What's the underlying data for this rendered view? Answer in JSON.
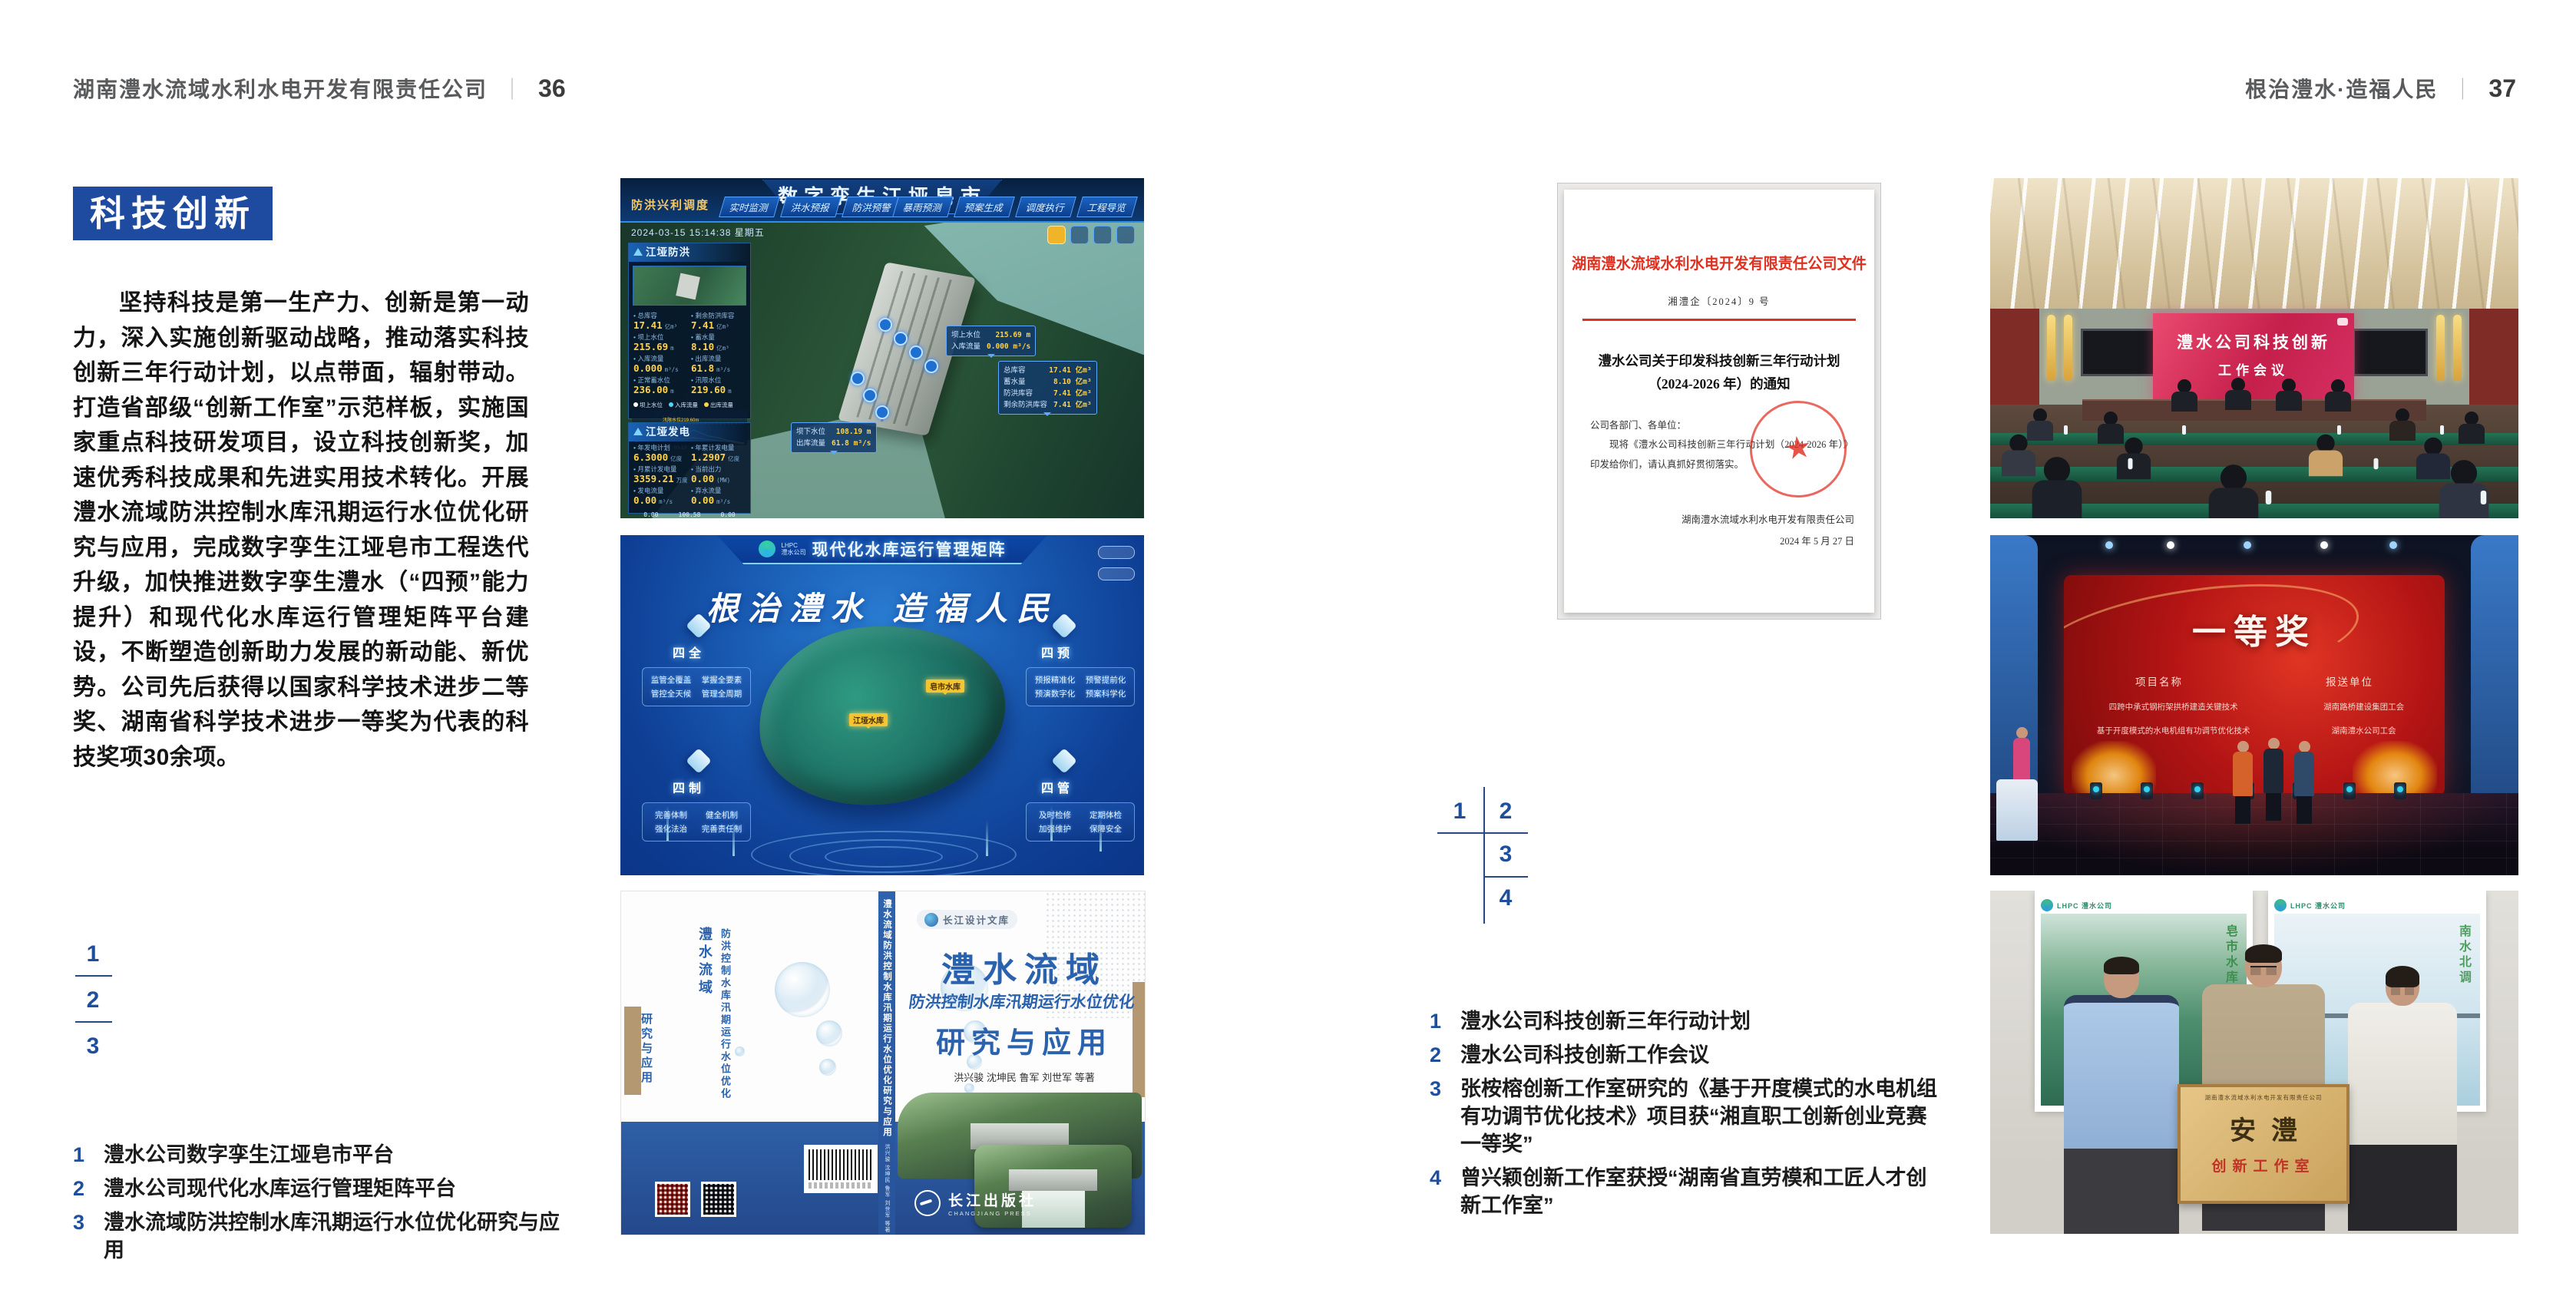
{
  "colors": {
    "accent_blue": "#1e4b9f",
    "caption_blue": "#1f4e9c",
    "doc_red": "#e03020",
    "band_blue": "#2e5fa6"
  },
  "page_left": {
    "header": {
      "company": "湖南澧水流域水利水电开发有限责任公司",
      "page_no": "36"
    },
    "section_badge": "科技创新",
    "body_text": "坚持科技是第一生产力、创新是第一动力，深入实施创新驱动战略，推动落实科技创新三年行动计划，以点带面，辐射带动。打造省部级“创新工作室”示范样板，实施国家重点科技研发项目，设立科技创新奖，加速优秀科技成果和先进实用技术转化。开展澧水流域防洪控制水库汛期运行水位优化研究与应用，完成数字孪生江垭皂市工程迭代升级，加快推进数字孪生澧水（“四预”能力提升）和现代化水库运行管理矩阵平台建设，不断塑造创新助力发展的新动能、新优势。公司先后获得以国家科学技术进步二等奖、湖南省科学技术进步一等奖为代表的科技奖项30余项。",
    "figure_nums": [
      "1",
      "2",
      "3"
    ],
    "captions": [
      {
        "num": "1",
        "text": "澧水公司数字孪生江垭皂市平台"
      },
      {
        "num": "2",
        "text": "澧水公司现代化水库运行管理矩阵平台"
      },
      {
        "num": "3",
        "text": "澧水流域防洪控制水库汛期运行水位优化研究与应用"
      }
    ]
  },
  "page_right": {
    "header": {
      "slogan": "根治澧水·造福人民",
      "page_no": "37"
    },
    "figure_nums": [
      "1",
      "2",
      "3",
      "4"
    ],
    "captions": [
      {
        "num": "1",
        "text": "澧水公司科技创新三年行动计划"
      },
      {
        "num": "2",
        "text": "澧水公司科技创新工作会议"
      },
      {
        "num": "3",
        "text": "张桉榕创新工作室研究的《基于开度模式的水电机组有功调节优化技术》项目获“湘直职工创新创业竞赛一等奖”"
      },
      {
        "num": "4",
        "text": "曾兴颖创新工作室获授“湖南省直劳模和工匠人才创新工作室”"
      }
    ]
  },
  "fig_dashboard": {
    "title": "数字孪生江垭皂市",
    "mode_label": "防洪兴利调度",
    "tabs_left": [
      "实时监测",
      "洪水预报",
      "防洪预警"
    ],
    "tabs_right": [
      "暴雨预测",
      "预案生成",
      "调度执行",
      "工程导览"
    ],
    "datetime": "2024-03-15 15:14:38 星期五",
    "panel_flood": {
      "title": "江垭防洪",
      "stats": [
        {
          "label": "总库容",
          "value": "17.41",
          "unit": "亿m³"
        },
        {
          "label": "剩余防洪库容",
          "value": "7.41",
          "unit": "亿m³"
        },
        {
          "label": "坝上水位",
          "value": "215.69",
          "unit": "m"
        },
        {
          "label": "蓄水量",
          "value": "8.10",
          "unit": "亿m³"
        },
        {
          "label": "入库流量",
          "value": "0.000",
          "unit": "m³/s"
        },
        {
          "label": "出库流量",
          "value": "61.8",
          "unit": "m³/s"
        },
        {
          "label": "正常蓄水位",
          "value": "236.00",
          "unit": "m"
        },
        {
          "label": "汛限水位",
          "value": "219.60",
          "unit": "m"
        }
      ]
    },
    "chart": {
      "legend": [
        "坝上水位",
        "入库流量",
        "出库流量"
      ],
      "x": [
        "03-12",
        "03-13",
        "03-13",
        "03-13",
        "03-14",
        "03-14"
      ],
      "annotation": "汛限水位219.60m"
    },
    "panel_power": {
      "title": "江垭发电",
      "stats": [
        {
          "label": "年发电计划",
          "value": "6.3000",
          "unit": "亿度"
        },
        {
          "label": "年累计发电量",
          "value": "1.2907",
          "unit": "亿度"
        },
        {
          "label": "月累计发电量",
          "value": "3359.21",
          "unit": "万度"
        },
        {
          "label": "当前出力",
          "value": "0.00",
          "unit": "(MW)"
        },
        {
          "label": "发电流量",
          "value": "0.00",
          "unit": "m³/s"
        },
        {
          "label": "弃水流量",
          "value": "0.00",
          "unit": "m³/s"
        }
      ],
      "units": [
        {
          "value": "0.00",
          "name": "1号机组"
        },
        {
          "value": "100.58",
          "name": "2号机组"
        },
        {
          "value": "0.00",
          "name": "3号机组"
        }
      ]
    },
    "tooltips": {
      "t1": [
        {
          "label": "坝上水位",
          "value": "215.69 m"
        },
        {
          "label": "入库流量",
          "value": "0.000 m³/s"
        }
      ],
      "t2": [
        {
          "label": "总库容",
          "value": "17.41 亿m³"
        },
        {
          "label": "蓄水量",
          "value": "8.10 亿m³"
        },
        {
          "label": "防洪库容",
          "value": "7.41 亿m³"
        },
        {
          "label": "剩余防洪库容",
          "value": "7.41 亿m³"
        }
      ],
      "t3": [
        {
          "label": "坝下水位",
          "value": "108.19 m"
        },
        {
          "label": "出库流量",
          "value": "61.8 m³/s"
        }
      ]
    }
  },
  "fig_matrix": {
    "logo_top": "LHPC",
    "logo_sub": "澧水公司",
    "title": "现代化水库运行管理矩阵",
    "slogan": "根治澧水 造福人民",
    "cards": [
      {
        "title": "四全",
        "items": [
          "监管全覆盖",
          "掌握全要素",
          "管控全天候",
          "管理全周期"
        ]
      },
      {
        "title": "四预",
        "items": [
          "预报精准化",
          "预警提前化",
          "预演数字化",
          "预案科学化"
        ]
      },
      {
        "title": "四制",
        "items": [
          "完善体制",
          "健全机制",
          "强化法治",
          "完善责任制"
        ]
      },
      {
        "title": "四管",
        "items": [
          "及时检修",
          "定期体检",
          "加强维护",
          "保障安全"
        ]
      }
    ],
    "markers": {
      "m1": "皂市水库",
      "m2": "江垭水库"
    }
  },
  "fig_book": {
    "series": "长江设计文库",
    "title_main": "澧水流域",
    "title_sub": "防洪控制水库汛期运行水位优化",
    "title_tail": "研究与应用",
    "authors": "洪兴骏  沈坤民  鲁军  刘世军  等著",
    "spine_title": "澧水流域防洪控制水库汛期运行水位优化研究与应用",
    "spine_authors": "洪兴骏 沈坤民 鲁军 刘世军 等著",
    "publisher": "长江出版社",
    "publisher_en": "CHANGJIANG PRESS",
    "back_title_1": "澧水流域",
    "back_title_2": "防洪控制水库汛期运行水位优化",
    "back_title_3": "研究与应用"
  },
  "fig_document": {
    "header": "湖南澧水流域水利水电开发有限责任公司文件",
    "doc_no": "湘澧企〔2024〕9 号",
    "title_line1": "澧水公司关于印发科技创新三年行动计划",
    "title_line2": "（2024-2026 年）的通知",
    "salutation": "公司各部门、各单位：",
    "body": "现将《澧水公司科技创新三年行动计划（2024-2026 年）》印发给你们，请认真抓好贯彻落实。",
    "signer": "湖南澧水流域水利水电开发有限责任公司",
    "date": "2024 年 5 月 27 日"
  },
  "fig_meeting": {
    "screen_line1": "澧水公司科技创新",
    "screen_line2": "工作会议"
  },
  "fig_award": {
    "title": "一等奖",
    "col_project": "项目名称",
    "col_org": "报送单位",
    "rows": [
      {
        "project": "四跨中承式钢桁架拱桥建造关键技术",
        "org": "湖南路桥建设集团工会"
      },
      {
        "project": "基于开度模式的水电机组有功调节优化技术",
        "org": "湖南澧水公司工会"
      }
    ]
  },
  "fig_plaque": {
    "org_line": "湖南澧水流域水利水电开发有限责任公司",
    "big_text": "安澧",
    "sub_text": "创新工作室",
    "poster_logo": "LHPC 澧水公司",
    "poster_left_text": "皂市水库",
    "poster_right_text": "南水北调"
  }
}
